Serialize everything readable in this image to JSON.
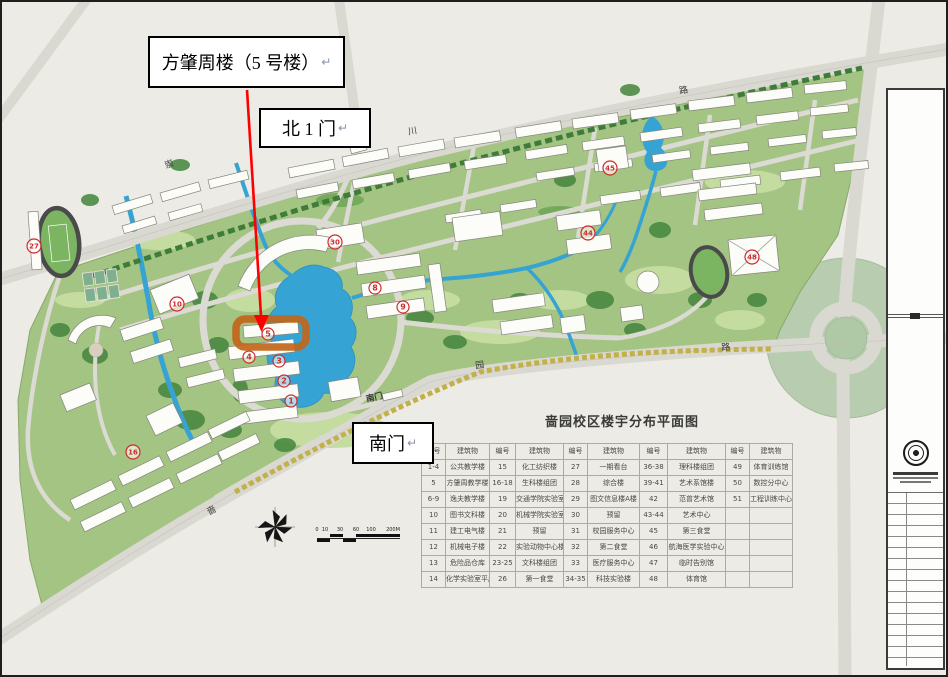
{
  "callouts": {
    "building_label": "方肇周楼（5 号楼）",
    "north_gate_label": "北 1 门",
    "south_gate_label": "南门",
    "pilcrow": "↵"
  },
  "map": {
    "road_labels": [
      {
        "text": "崇",
        "x": 170,
        "y": 167,
        "rot": -18
      },
      {
        "text": "川",
        "x": 413,
        "y": 134,
        "rot": -10
      },
      {
        "text": "路",
        "x": 684,
        "y": 93,
        "rot": -8
      },
      {
        "text": "啬",
        "x": 213,
        "y": 513,
        "rot": -28
      },
      {
        "text": "园",
        "x": 480,
        "y": 368,
        "rot": -6
      },
      {
        "text": "路",
        "x": 726,
        "y": 350,
        "rot": -4
      }
    ],
    "gate_label": {
      "text": "南门",
      "x": 375,
      "y": 400,
      "rot": -13
    },
    "markers": [
      {
        "n": "27",
        "x": 34,
        "y": 246
      },
      {
        "n": "10",
        "x": 177,
        "y": 304
      },
      {
        "n": "30",
        "x": 335,
        "y": 242
      },
      {
        "n": "5",
        "x": 268,
        "y": 334
      },
      {
        "n": "4",
        "x": 249,
        "y": 357
      },
      {
        "n": "3",
        "x": 279,
        "y": 361
      },
      {
        "n": "2",
        "x": 284,
        "y": 381
      },
      {
        "n": "1",
        "x": 291,
        "y": 401
      },
      {
        "n": "8",
        "x": 375,
        "y": 288
      },
      {
        "n": "9",
        "x": 403,
        "y": 307
      },
      {
        "n": "44",
        "x": 588,
        "y": 233
      },
      {
        "n": "45",
        "x": 610,
        "y": 168
      },
      {
        "n": "48",
        "x": 752,
        "y": 257
      },
      {
        "n": "16",
        "x": 133,
        "y": 452
      }
    ],
    "scale": {
      "marks": [
        {
          "t": "0",
          "x": 317
        },
        {
          "t": "10",
          "x": 325
        },
        {
          "t": "30",
          "x": 340
        },
        {
          "t": "60",
          "x": 356
        },
        {
          "t": "100",
          "x": 371
        },
        {
          "t": "200M",
          "x": 393
        }
      ]
    },
    "icons": {
      "compass": "compass-rose-icon",
      "seal": "university-seal-icon"
    },
    "colors": {
      "background": "#ECEBE5",
      "road": "#D9D8D1",
      "campus_green": "#A3C482",
      "lawn": "#C5DCA0",
      "forest": "#47873F",
      "water": "#35A3D4",
      "building": "#FCFCF9",
      "highlight": "#C2661C",
      "arrow": "#FF0000",
      "marker_red": "#CF2B2B",
      "roundabout": "#B8CDAF"
    }
  },
  "legend": {
    "title": "啬园校区楼宇分布平面图",
    "col_headers": [
      "编号",
      "建筑物"
    ],
    "groups": [
      [
        [
          "1-4",
          "公共教学楼"
        ],
        [
          "5",
          "方肇周教学楼"
        ],
        [
          "6-9",
          "逸夫教学楼"
        ],
        [
          "10",
          "图书文科楼"
        ],
        [
          "11",
          "建工电气楼"
        ],
        [
          "12",
          "机械电子楼"
        ],
        [
          "13",
          "危险品仓库"
        ],
        [
          "14",
          "化学实验室平房"
        ]
      ],
      [
        [
          "15",
          "化工纺织楼"
        ],
        [
          "16-18",
          "生科楼组团"
        ],
        [
          "19",
          "交通学院实验室"
        ],
        [
          "20",
          "机械学院实验室"
        ],
        [
          "21",
          "预留"
        ],
        [
          "22",
          "实验动物中心楼"
        ],
        [
          "23-25",
          "文科楼组团"
        ],
        [
          "26",
          "第一食堂"
        ]
      ],
      [
        [
          "27",
          "一期看台"
        ],
        [
          "28",
          "综合楼"
        ],
        [
          "29",
          "图文信息楼A楼"
        ],
        [
          "30",
          "预留"
        ],
        [
          "31",
          "校园服务中心"
        ],
        [
          "32",
          "第二食堂"
        ],
        [
          "33",
          "医疗服务中心"
        ],
        [
          "34-35",
          "科技实验楼"
        ]
      ],
      [
        [
          "36-38",
          "理科楼组团"
        ],
        [
          "39-41",
          "艺术系馆楼"
        ],
        [
          "42",
          "范曾艺术馆"
        ],
        [
          "43-44",
          "艺术中心"
        ],
        [
          "45",
          "第三食堂"
        ],
        [
          "46",
          "航海医学实验中心"
        ],
        [
          "47",
          "临时告别馆"
        ],
        [
          "48",
          "体育馆"
        ]
      ],
      [
        [
          "49",
          "体育训练馆"
        ],
        [
          "50",
          "数控分中心"
        ],
        [
          "51",
          "工程训练中心"
        ],
        [
          "",
          ""
        ],
        [
          "",
          ""
        ],
        [
          "",
          ""
        ],
        [
          "",
          ""
        ],
        [
          "",
          ""
        ]
      ]
    ]
  }
}
